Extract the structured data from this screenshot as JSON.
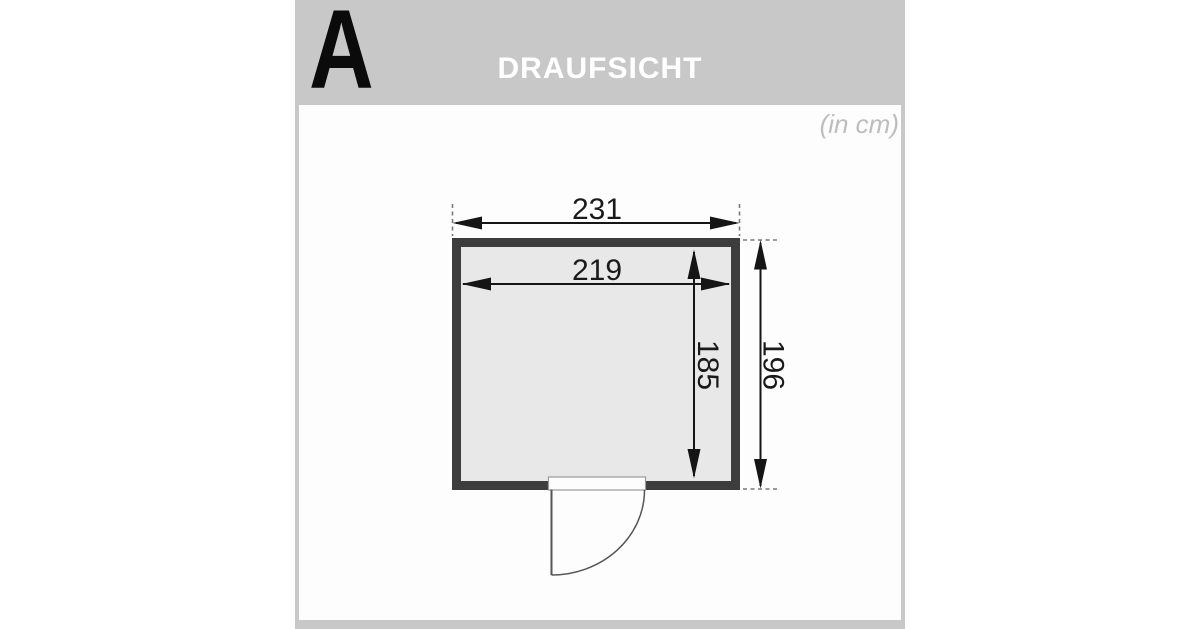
{
  "header": {
    "section_label": "A",
    "title": "DRAUFSICHT"
  },
  "canvas": {
    "unit_note": "(in cm)"
  },
  "diagram": {
    "type": "floor-plan-top-view",
    "dimensions": {
      "outer_width_cm": "231",
      "inner_width_cm": "219",
      "inner_depth_cm": "185",
      "outer_depth_cm": "196"
    },
    "colors": {
      "frame_bg": "#c8c8c8",
      "panel_bg": "#fdfdfd",
      "wall": "#3d3d3d",
      "interior": "#e8e8e8",
      "dimension_line": "#151515",
      "extension_line": "#7a7a7a",
      "door_line": "#555555",
      "door_opening_fill": "#fdfdfd",
      "door_opening_stroke": "#9a9a9a",
      "title_text": "#ffffff",
      "section_letter_text": "#0b0b0b",
      "unit_note_text": "#bdbdbd"
    }
  }
}
